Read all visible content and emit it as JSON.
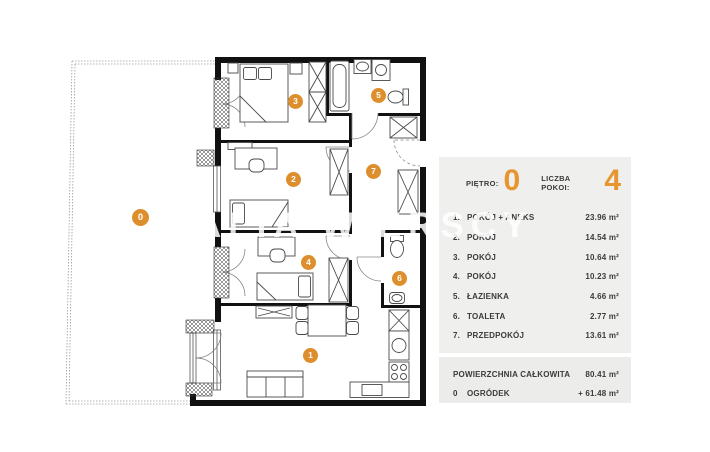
{
  "watermark": {
    "text": "ALIA WIERSCY"
  },
  "plan": {
    "badges": [
      {
        "label": "0",
        "name": "garden"
      },
      {
        "label": "1",
        "name": "living-room"
      },
      {
        "label": "2",
        "name": "room-2"
      },
      {
        "label": "3",
        "name": "room-3"
      },
      {
        "label": "4",
        "name": "room-4"
      },
      {
        "label": "5",
        "name": "bathroom"
      },
      {
        "label": "6",
        "name": "toilet"
      },
      {
        "label": "7",
        "name": "hallway"
      }
    ]
  },
  "panel": {
    "floor_label": "PIĘTRO:",
    "floor_value": "0",
    "rooms_count_label": "LICZBA POKOI:",
    "rooms_count_value": "4",
    "rooms": [
      {
        "num": "1.",
        "label": "POKÓJ + ANEKS",
        "area": "23.96 m²"
      },
      {
        "num": "2.",
        "label": "POKÓJ",
        "area": "14.54 m²"
      },
      {
        "num": "3.",
        "label": "POKÓJ",
        "area": "10.64 m²"
      },
      {
        "num": "4.",
        "label": "POKÓJ",
        "area": "10.23 m²"
      },
      {
        "num": "5.",
        "label": "ŁAZIENKA",
        "area": "4.66 m²"
      },
      {
        "num": "6.",
        "label": "TOALETA",
        "area": "2.77 m²"
      },
      {
        "num": "7.",
        "label": "PRZEDPOKÓJ",
        "area": "13.61 m²"
      }
    ],
    "totals": [
      {
        "num": "",
        "label": "POWIERZCHNIA CAŁKOWITA",
        "area": "80.41 m²"
      },
      {
        "num": "0",
        "label": "OGRÓDEK",
        "area": "+ 61.48 m²"
      }
    ],
    "colors": {
      "accent": "#E8952F",
      "badge": "#DE8F2D",
      "panel_bg": "#EFEFEE",
      "totals_bg": "#ECECEB",
      "text": "#3B3B3B"
    }
  }
}
